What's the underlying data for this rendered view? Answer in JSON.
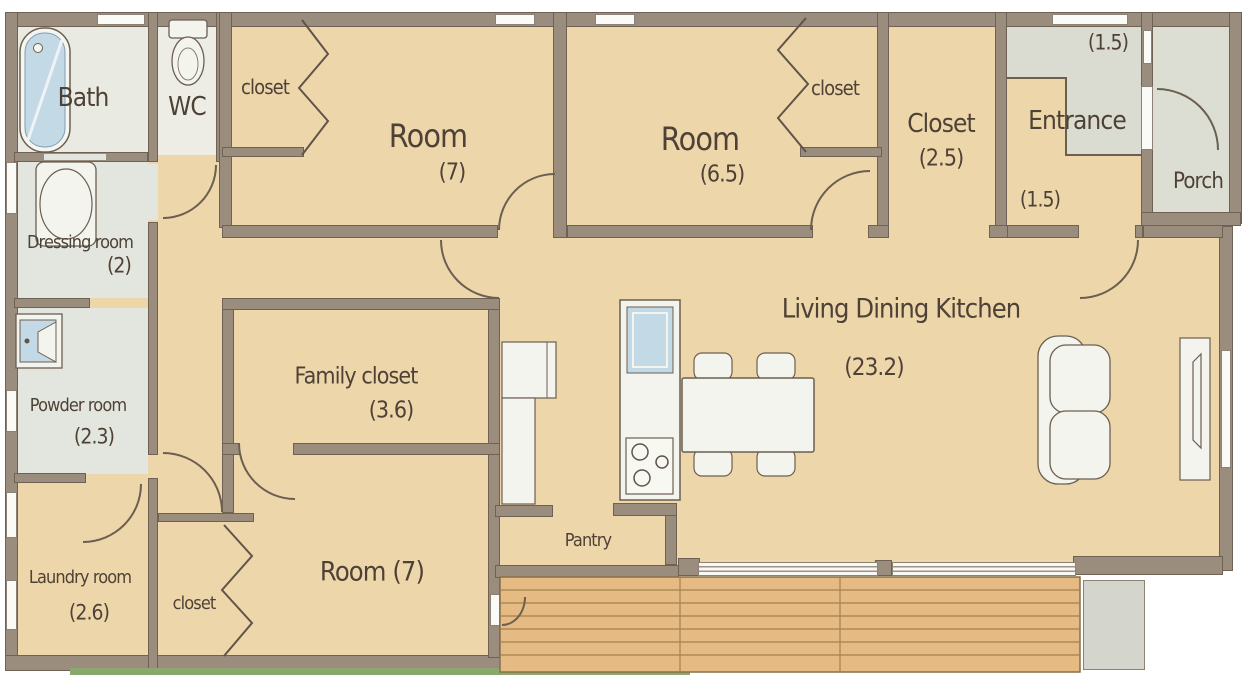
{
  "plan": {
    "rooms": {
      "bath": {
        "label": "Bath"
      },
      "wc": {
        "label": "WC"
      },
      "closet_top_left": {
        "label": "closet"
      },
      "room_top_left": {
        "label": "Room",
        "size": "(7)"
      },
      "room_top_right": {
        "label": "Room",
        "size": "(6.5)"
      },
      "closet_top_right": {
        "label": "closet"
      },
      "closet_25": {
        "label": "Closet",
        "size": "(2.5)"
      },
      "entrance": {
        "label": "Entrance",
        "upper_size": "(1.5)",
        "lower_size": "(1.5)"
      },
      "porch": {
        "label": "Porch"
      },
      "dressing_room": {
        "label": "Dressing room",
        "size": "(2)"
      },
      "powder_room": {
        "label": "Powder room",
        "size": "(2.3)"
      },
      "laundry_room": {
        "label": "Laundry room",
        "size": "(2.6)"
      },
      "closet_bottom": {
        "label": "closet"
      },
      "room_bottom": {
        "label": "Room (7)"
      },
      "family_closet": {
        "label": "Family closet",
        "size": "(3.6)"
      },
      "ldk": {
        "label": "Living Dining Kitchen",
        "size": "(23.2)"
      },
      "pantry": {
        "label": "Pantry"
      }
    },
    "colors": {
      "wall": "#9a8d7e",
      "room_fill": "#eed6ab",
      "wet_area_fill": "#e3e6de",
      "entrance_tile_fill": "#dadcd2",
      "deck_fill": "#e5bb83",
      "water": "#c3d9e6",
      "text": "#4e4236"
    }
  }
}
